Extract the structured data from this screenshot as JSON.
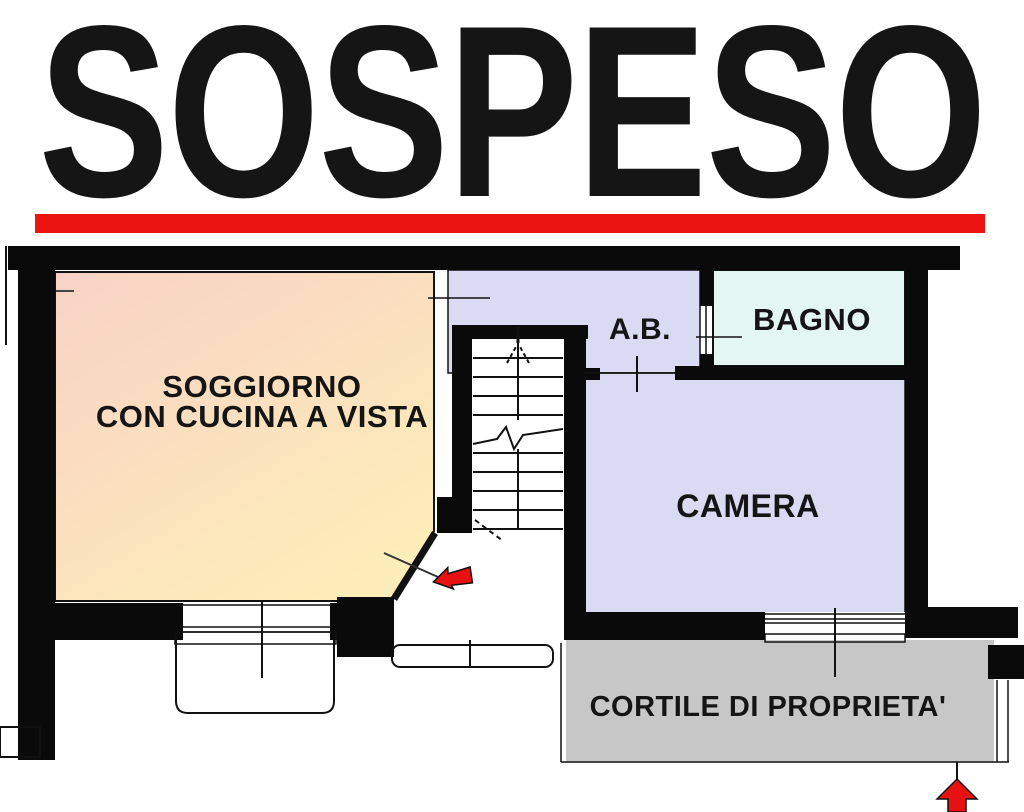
{
  "banner": {
    "text": "SOSPESO"
  },
  "plan": {
    "rooms": {
      "soggiorno": {
        "line1": "SOGGIORNO",
        "line2": "CON CUCINA A VISTA"
      },
      "ab": {
        "label": "A.B."
      },
      "bagno": {
        "label": "BAGNO"
      },
      "camera": {
        "label": "CAMERA"
      },
      "cortile": {
        "label": "CORTILE DI PROPRIETA'"
      }
    },
    "colors": {
      "banner_red": "#ec1313",
      "arrow_red": "#e81111",
      "wall": "#0a0a0a",
      "soggiorno_top": "#f8d2c6",
      "soggiorno_bottom": "#fdedb8",
      "lavender": "#dadaf3",
      "bagno": "#e4f6f1",
      "cortile": "#c7c7c7"
    }
  }
}
